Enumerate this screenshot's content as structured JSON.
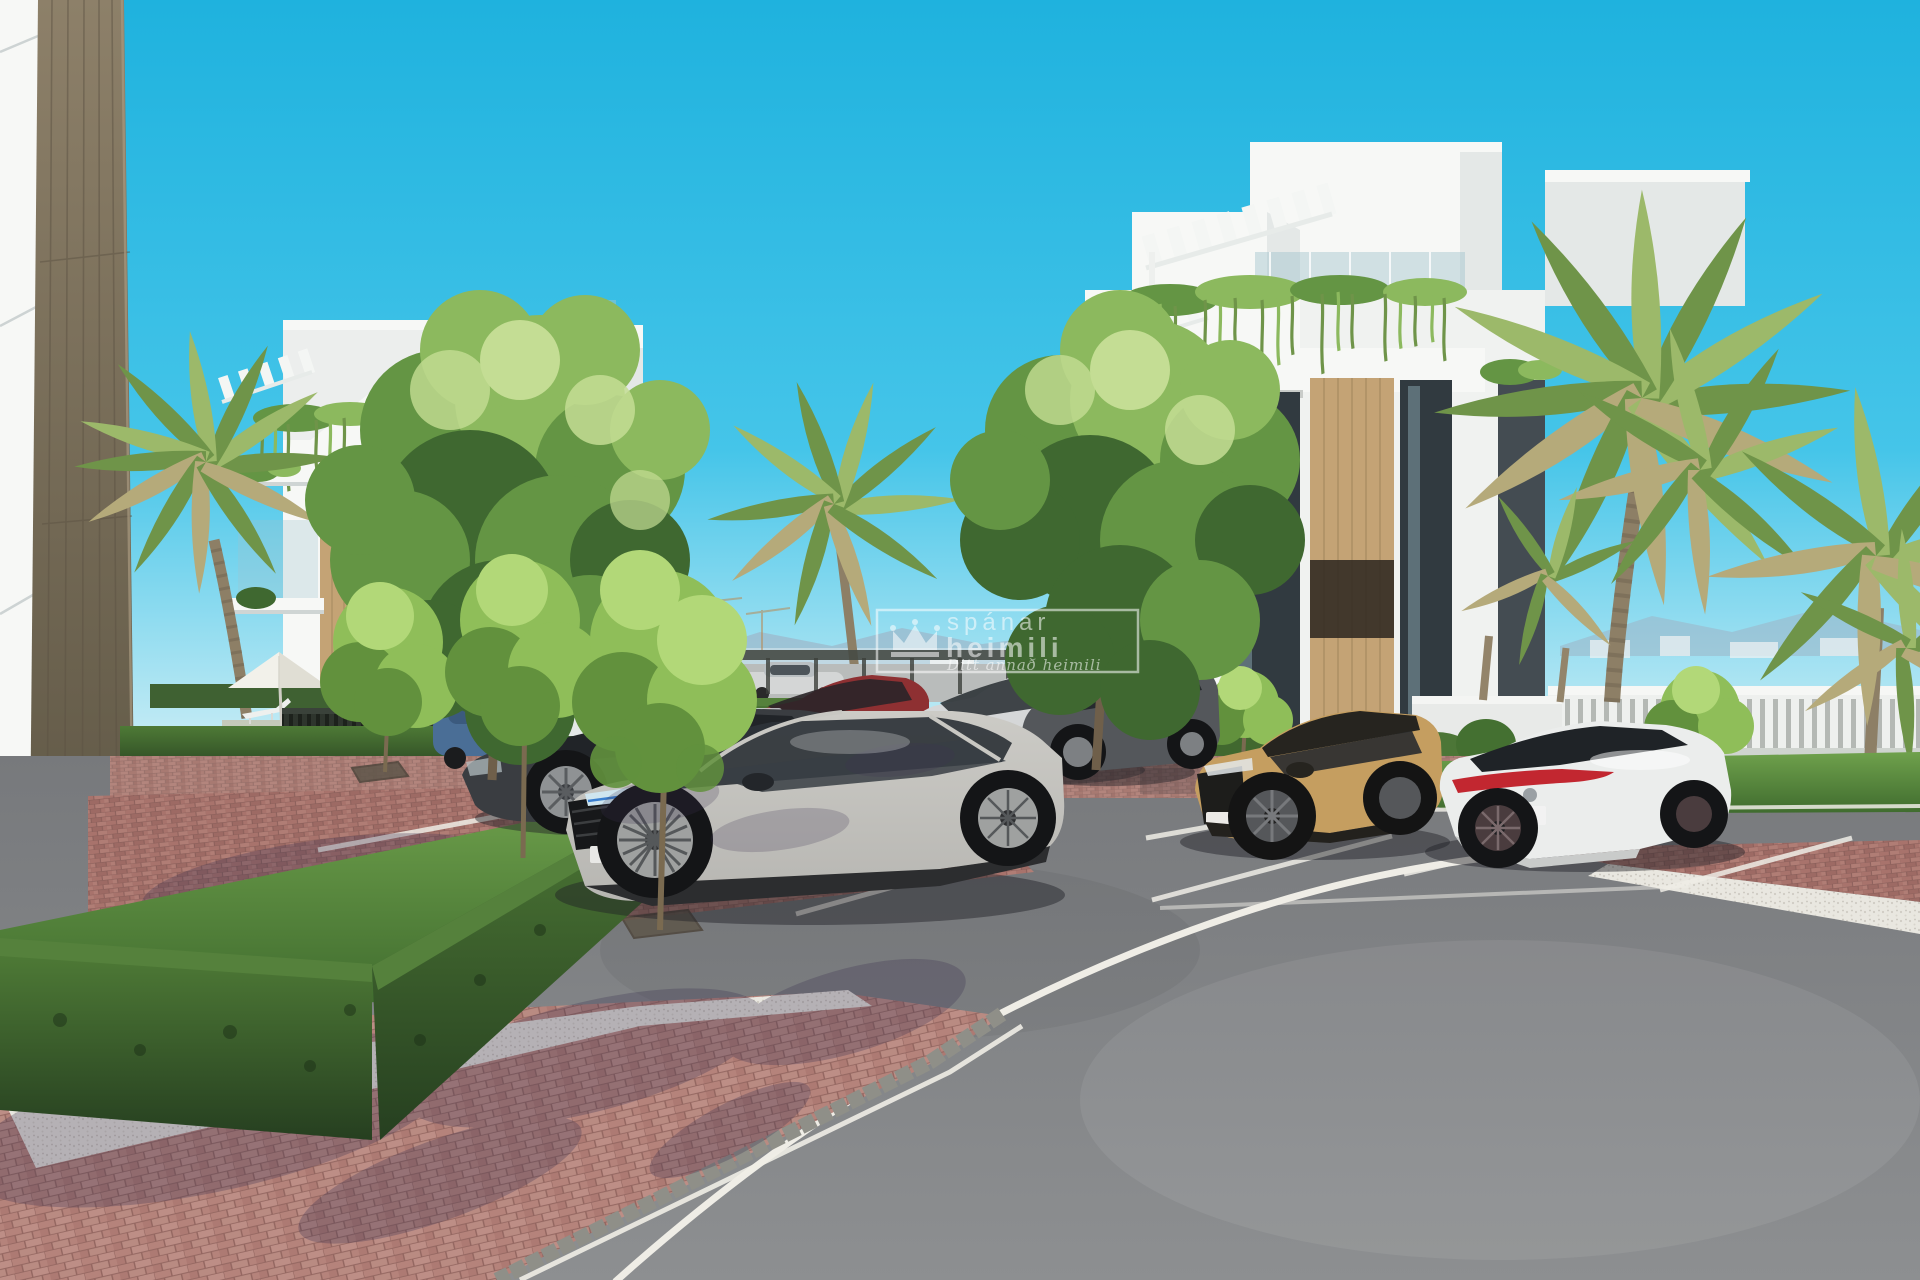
{
  "watermark": {
    "brand_line1": "spánar",
    "brand_line2": "heimili",
    "tagline": "Ditt annað heimili",
    "icon": "crown-icon",
    "color": "#ffffff",
    "opacity": "0.55"
  },
  "scene": {
    "type": "architectural-3d-render",
    "labels": [
      "sky",
      "mountains",
      "distant-city",
      "white-apartment-building-left",
      "white-apartment-building-right",
      "rooftop-pergola",
      "hanging-plants",
      "palm-trees",
      "deciduous-trees",
      "boxwood-hedge",
      "lawn",
      "pool-parasol",
      "sun-loungers",
      "pool-fence",
      "perimeter-fence",
      "parking-lot",
      "brick-pavement",
      "white-gravel",
      "asphalt-road",
      "road-marking",
      "silver-suv",
      "dark-sedan",
      "red-suv",
      "white-suv",
      "dark-gray-suv",
      "tan-suv",
      "white-sedan",
      "blue-car",
      "foreground-wall-column"
    ]
  },
  "colors": {
    "sky_top": "#1fb2de",
    "sky_mid": "#45c5e9",
    "sky_horizon": "#c9edf5",
    "white_wall": "#f7f8f6",
    "white_shade": "#e4e8e7",
    "white_deep": "#cdd4d5",
    "wood_panel": "#c4a375",
    "wood_dark": "#9a7f57",
    "column_light": "#8d8069",
    "column_dark": "#57503f",
    "glass_dark": "#313a40",
    "glass_light": "#9fc3cc",
    "hedge_light": "#4e7a36",
    "hedge_dark": "#263f20",
    "grass_light": "#6fa14c",
    "grass_dark": "#3f6b2e",
    "tree_light": "#8cb95e",
    "tree_mid": "#649544",
    "tree_dark": "#3f6830",
    "tree_hi": "#c4dd94",
    "bright_tree": "#8fbe59",
    "bright_tree_hi": "#b2d878",
    "bright_tree_dark": "#62913d",
    "palm_light": "#9cb96a",
    "palm_mid": "#6f9449",
    "palm_dry": "#b5aa7a",
    "palm_trunk": "#8d7f66",
    "brick_main": "#a8736c",
    "brick_light": "#bd8e86",
    "brick_mortar": "#8a5f5a",
    "brick_fg": "#b5837b",
    "gravel": "#e9e7e0",
    "asphalt": "#8d8f91",
    "asphalt_dark": "#77797c",
    "road_line": "#efede6",
    "cobble": "#8f8f88",
    "mountain": "#9db7c9",
    "city": "#eef1f2",
    "fence_dark": "#2a2f28",
    "fence_white": "#eef0ee",
    "car_silver": "#b7b6b2",
    "car_dark": "#3a3d41",
    "car_red": "#8e3032",
    "car_white": "#dcdedf",
    "car_gray": "#54575b",
    "car_tan": "#c59e60",
    "car_sedan_white": "#ebedec",
    "car_blue": "#4a6e96",
    "tail_red": "#c22730",
    "wheel_dark": "#1b1c1e",
    "rim": "#8f9294",
    "shadow": "#3d3352",
    "watermark": "#ffffff"
  }
}
